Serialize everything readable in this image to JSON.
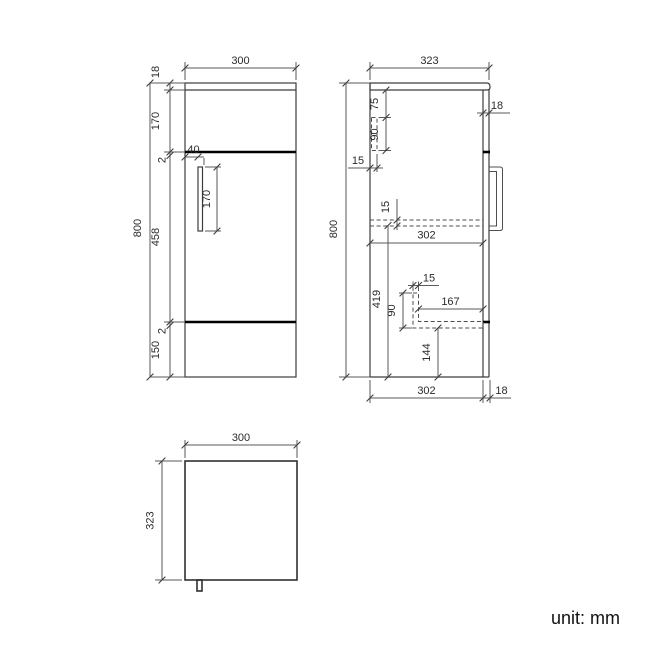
{
  "footer": {
    "unit_label": "unit: mm"
  },
  "colors": {
    "background": "#ffffff",
    "line": "#3d3d3d",
    "dim_line": "#5a5a5a",
    "gap_line": "#000000",
    "text": "#2b2b2b"
  },
  "views": {
    "front": {
      "title": "front view",
      "dims": {
        "overall_width": "300",
        "worktop_thickness": "18",
        "drawer_front_height": "170",
        "gap_upper": "2",
        "door_height": "458",
        "gap_lower": "2",
        "base_height": "150",
        "overall_height": "800",
        "handle_inset": "40",
        "handle_length": "170"
      }
    },
    "side": {
      "title": "side view",
      "dims": {
        "overall_depth": "323",
        "overall_height": "800",
        "back_rail_offset": "75",
        "back_rail_height": "90",
        "back_rail_thickness": "15",
        "front_panel_thickness": "18",
        "shelf_thickness": "15",
        "internal_depth": "302",
        "lower_cavity_height": "419",
        "support_thickness": "15",
        "support_height": "90",
        "support_length": "167",
        "support_to_base": "144",
        "internal_depth_base": "302",
        "front_panel_thickness_base": "18"
      }
    },
    "top": {
      "title": "top view",
      "dims": {
        "overall_width": "300",
        "overall_depth": "323"
      }
    }
  }
}
